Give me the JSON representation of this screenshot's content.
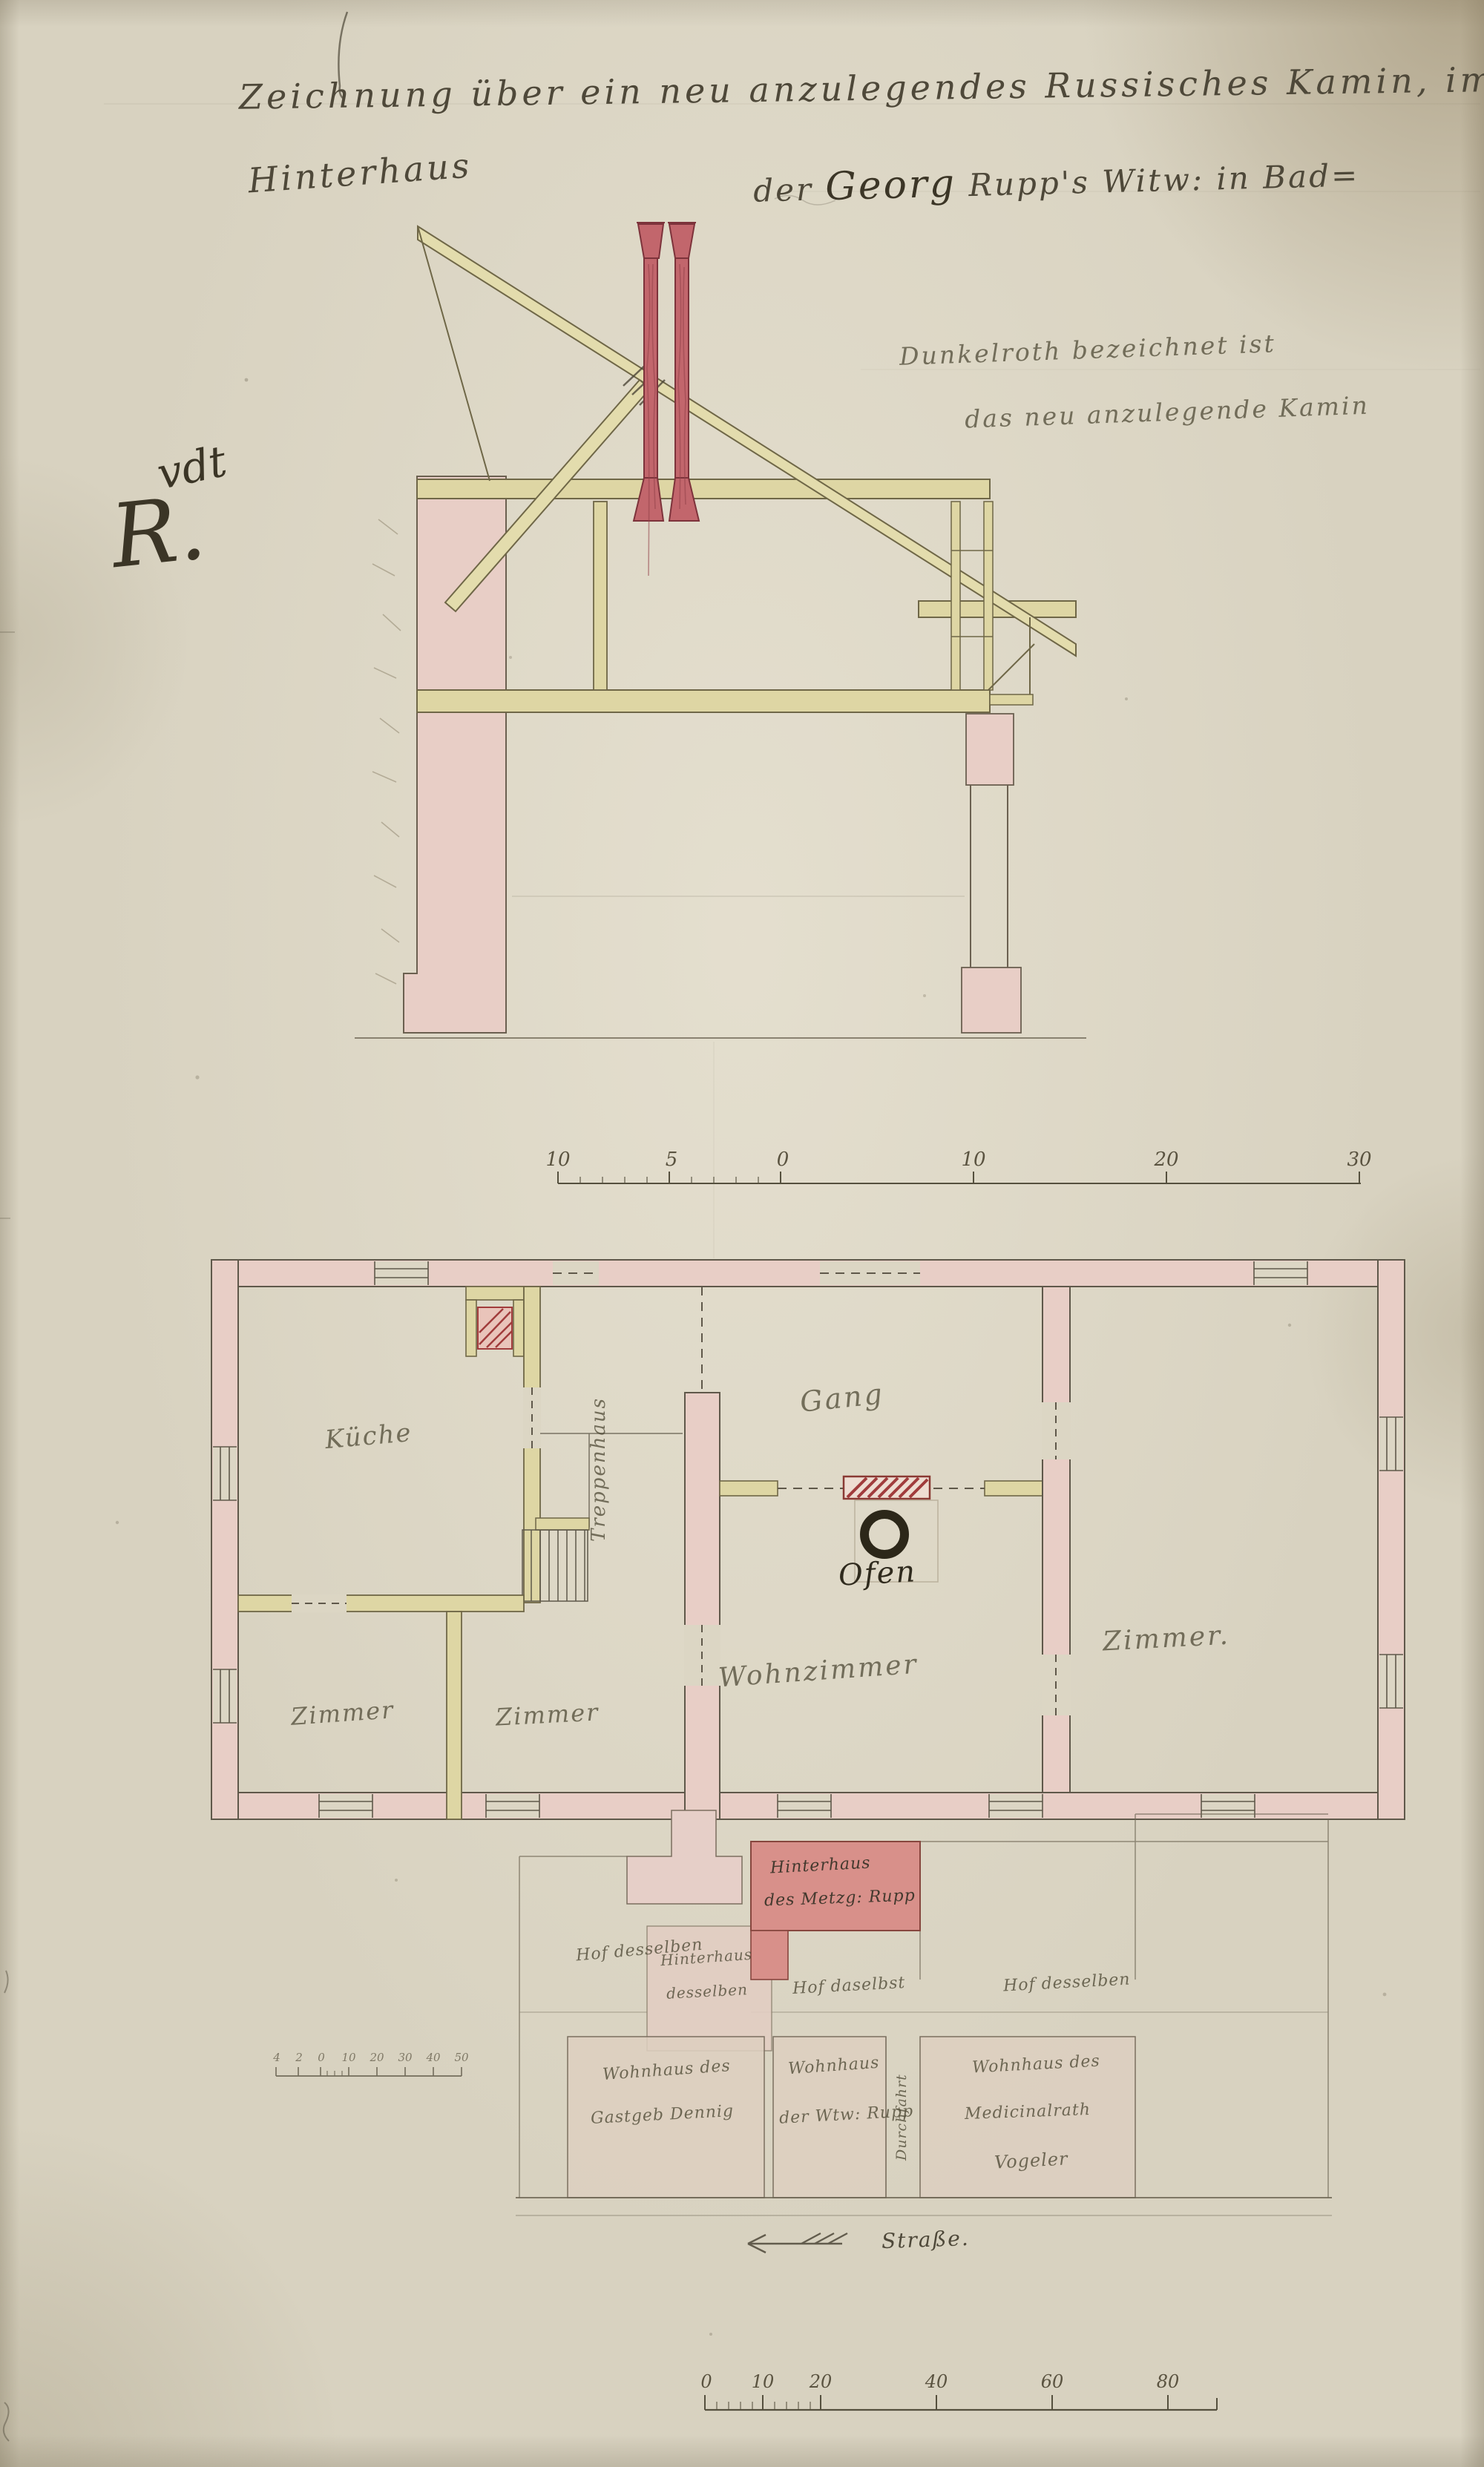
{
  "title": {
    "line1": "Zeichnung über ein neu anzulegendes Russisches Kamin, im",
    "line2_left": "Hinterhaus",
    "line2_right_prefix": "der ",
    "line2_right_name": "Georg",
    "line2_right_suffix": " Rupp's Witw: in Bad="
  },
  "visa": {
    "line1": "vdt",
    "line2": "R."
  },
  "note": {
    "line1": "Dunkelroth bezeichnet ist",
    "line2": "das neu anzulegende Kamin"
  },
  "section_scale": {
    "t0": "10",
    "t1": "5",
    "t2": "0",
    "t3": "10",
    "t4": "20",
    "t5": "30"
  },
  "floor_plan": {
    "kueche": "Küche",
    "treppenhaus": "Treppenhaus",
    "gang": "Gang",
    "zimmer_sw": "Zimmer",
    "zimmer_s": "Zimmer",
    "wohnzimmer": "Wohnzimmer",
    "zimmer_e": "Zimmer.",
    "ofen": "Ofen"
  },
  "site_plan": {
    "pale_block_line1": "Hinterhaus",
    "pale_block_line2": "desselben",
    "red_block_line1": "Hinterhaus",
    "red_block_line2": "des Metzg: Rupp",
    "hof_left": "Hof desselben",
    "hof_mid": "Hof daselbst",
    "hof_right": "Hof desselben",
    "house_left_line1": "Wohnhaus des",
    "house_left_line2": "Gastgeb Dennig",
    "house_mid_line1": "Wohnhaus",
    "house_mid_line2": "der Wtw: Rupp",
    "lane": "Durchfahrt",
    "house_right_line1": "Wohnhaus des",
    "house_right_line2": "Medicinalrath",
    "house_right_line3": "Vogeler",
    "street": "Straße."
  },
  "site_scale": {
    "t0": "0",
    "t1": "10",
    "t2": "20",
    "t3": "40",
    "t4": "60",
    "t5": "80"
  },
  "mini_scale": {
    "t0": "4",
    "t1": "2",
    "t2": "0",
    "t3": "10",
    "t4": "20",
    "t5": "30",
    "t6": "40",
    "t7": "50"
  },
  "colors": {
    "paper": "#d8d2c0",
    "wall_pink": "#e8cec6",
    "wood_yellow": "#ded6a4",
    "chimney_red": "#c2666c",
    "red_block": "#d8908a",
    "ink": "#55503c"
  }
}
